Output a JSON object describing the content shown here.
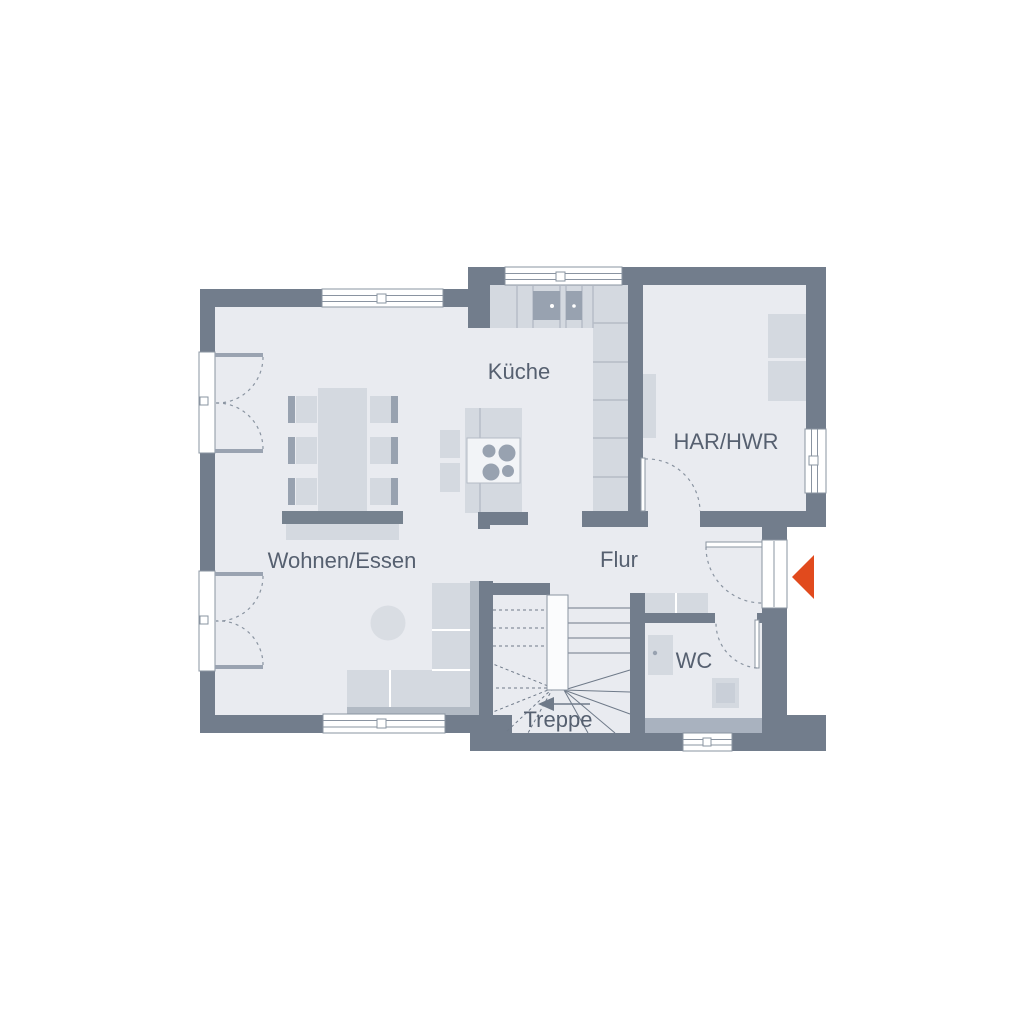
{
  "colors": {
    "background": "#ffffff",
    "wall": "#727d8c",
    "wall-light": "#a9b2bf",
    "floor": "#e9ebf0",
    "furniture": "#d4d9e0",
    "furniture-mid": "#b2bac4",
    "furniture-dark": "#98a2b0",
    "bench-dark": "#76828f",
    "outline": "#8a94a1",
    "divider": "#b5bcc6",
    "leaf": "#9aa3b1",
    "tread": "#6f7a89",
    "text": "#566070",
    "accent": "#e14a1d"
  },
  "rooms": {
    "kueche": {
      "label": "Küche"
    },
    "har_hwr": {
      "label": "HAR/HWR"
    },
    "wohnen_essen": {
      "label": "Wohnen/Essen"
    },
    "flur": {
      "label": "Flur"
    },
    "wc": {
      "label": "WC"
    },
    "treppe": {
      "label": "Treppe"
    }
  },
  "icons": {
    "entrance_marker": "triangle-left"
  }
}
